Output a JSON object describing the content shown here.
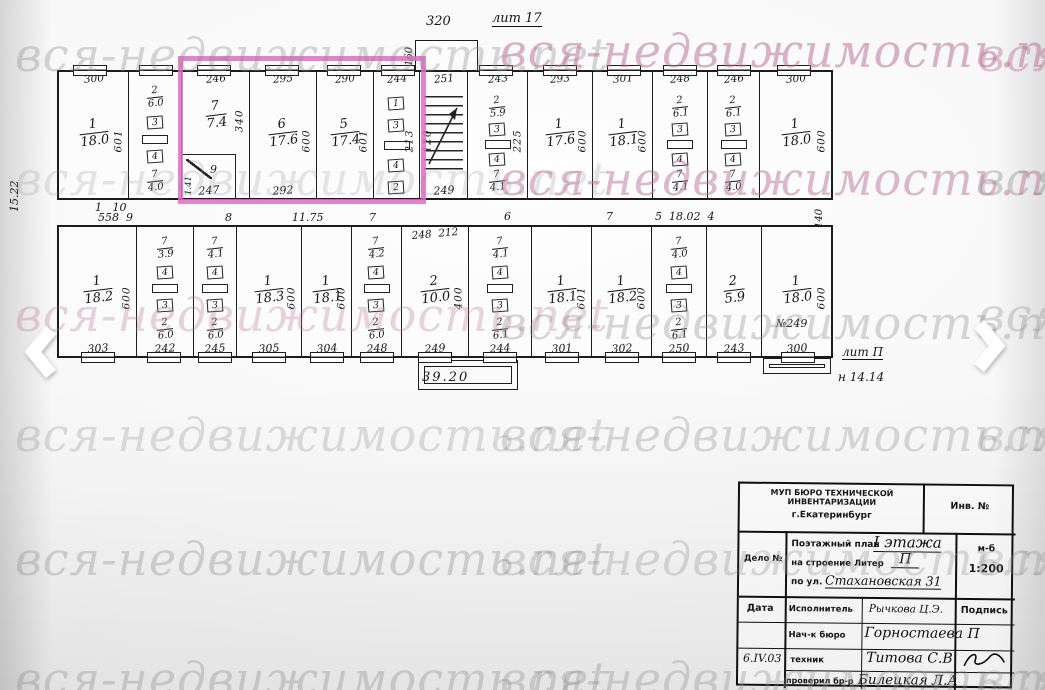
{
  "watermark": {
    "text": "вся-недвижимость.net"
  },
  "icons": {
    "prev": "chevron-left",
    "next": "chevron-right"
  },
  "plan": {
    "highlight_color": "#e06cc4",
    "lit_top": "лит 17",
    "dim_320": "320",
    "dim_160": "160",
    "left_height": "15.22",
    "dim_140": "140",
    "bottom_length": "39.20",
    "lit_right": "лит П",
    "height_right": "н 14.14",
    "corridor": [
      "1   10",
      "558  9",
      "8",
      "11.75",
      "7",
      "6",
      "7",
      "5  18.02  4"
    ],
    "top": [
      {
        "t": "300",
        "n": "1",
        "a": "18.0",
        "v": "601"
      },
      {
        "k_n": "2",
        "k_a": "6.0",
        "b1": "3",
        "b2": "4",
        "h_n": "7",
        "h_a": "4.0"
      },
      {
        "t": "246",
        "n": "7",
        "a": "7.4",
        "v": "340",
        "s_n": "9",
        "s_d": "247",
        "s_t": "1.41"
      },
      {
        "t": "295",
        "n": "6",
        "a": "17.6",
        "v": "600",
        "b": "292"
      },
      {
        "t": "290",
        "n": "5",
        "a": "17.4",
        "v": "601"
      },
      {
        "t": "244",
        "v": "213",
        "l1": "1",
        "l2": "3",
        "l3": "4",
        "l4": "2"
      },
      {
        "t": "251",
        "b": "249",
        "v": "120"
      },
      {
        "t": "243",
        "k_n": "2",
        "k_a": "5.9",
        "v": "225",
        "b1": "3",
        "b2": "4",
        "h_n": "7",
        "h_a": "4.1"
      },
      {
        "t": "293",
        "n": "1",
        "a": "17.6",
        "v": "600"
      },
      {
        "t": "301",
        "n": "1",
        "a": "18.1",
        "v": "600"
      },
      {
        "t": "248",
        "k_n": "2",
        "k_a": "6.1",
        "b1": "3",
        "b2": "4",
        "h_n": "7",
        "h_a": "4.1"
      },
      {
        "t": "246",
        "k_n": "2",
        "k_a": "6.1",
        "b1": "3",
        "b2": "4",
        "h_n": "7",
        "h_a": "4.0"
      },
      {
        "t": "300",
        "n": "1",
        "a": "18.0",
        "v": "600"
      }
    ],
    "bottom": [
      {
        "n": "1",
        "a": "18.2",
        "v": "600",
        "b": "303"
      },
      {
        "h_n": "7",
        "h_a": "3.9",
        "b1": "4",
        "b2": "3",
        "k_n": "2",
        "k_a": "6.0",
        "b": "242"
      },
      {
        "h_n": "7",
        "h_a": "4.1",
        "b1": "4",
        "b2": "3",
        "k_n": "2",
        "k_a": "6.0",
        "b": "245"
      },
      {
        "n": "1",
        "a": "18.3",
        "v": "600",
        "b": "305"
      },
      {
        "n": "1",
        "a": "18.1",
        "v": "600",
        "b": "304"
      },
      {
        "h_n": "7",
        "h_a": "4.2",
        "b1": "4",
        "b2": "3",
        "k_n": "2",
        "k_a": "6.0",
        "b": "248"
      },
      {
        "t": "248  212",
        "n": "2",
        "a": "10.0",
        "v": "400",
        "b": "249"
      },
      {
        "h_n": "7",
        "h_a": "4.1",
        "b1": "4",
        "b2": "3",
        "k_n": "2",
        "k_a": "6.1",
        "b": "244"
      },
      {
        "n": "1",
        "a": "18.1",
        "v": "601",
        "b": "301"
      },
      {
        "n": "1",
        "a": "18.2",
        "v": "600",
        "b": "302"
      },
      {
        "h_n": "7",
        "h_a": "4.0",
        "b1": "4",
        "b2": "3",
        "k_n": "2",
        "k_a": "6.1",
        "b": "250"
      },
      {
        "n": "2",
        "a": "5.9",
        "b": "243"
      },
      {
        "n": "1",
        "a": "18.0",
        "v": "600",
        "note": "№249",
        "b": "300"
      }
    ]
  },
  "stamp": {
    "org_line1": "МУП БЮРО ТЕХНИЧЕСКОЙ ИНВЕНТАРИЗАЦИИ",
    "org_line2": "г.Екатеринбург",
    "inv": "Инв. №",
    "delo": "Дело №",
    "plan_label": "Поэтажный план",
    "plan_value": "I этажа",
    "liter_label": "на строение Литер",
    "liter_value": "П",
    "street_label": "по ул.",
    "street_value": "Стахановская 31",
    "scale_label": "м-б",
    "scale_value": "1:200",
    "date_label": "Дата",
    "executor_label": "Исполнитель",
    "executor_value": "Рычкова Ц.Э.",
    "sign_label": "Подпись",
    "chief_label": "Нач-к бюро",
    "chief_value": "Горностаева П",
    "date_value": "6.IV.03",
    "tech_label": "техник",
    "tech_value": "Титова С.В",
    "check_label": "проверил бр-р",
    "check_value": "Билецкая Л.А"
  }
}
